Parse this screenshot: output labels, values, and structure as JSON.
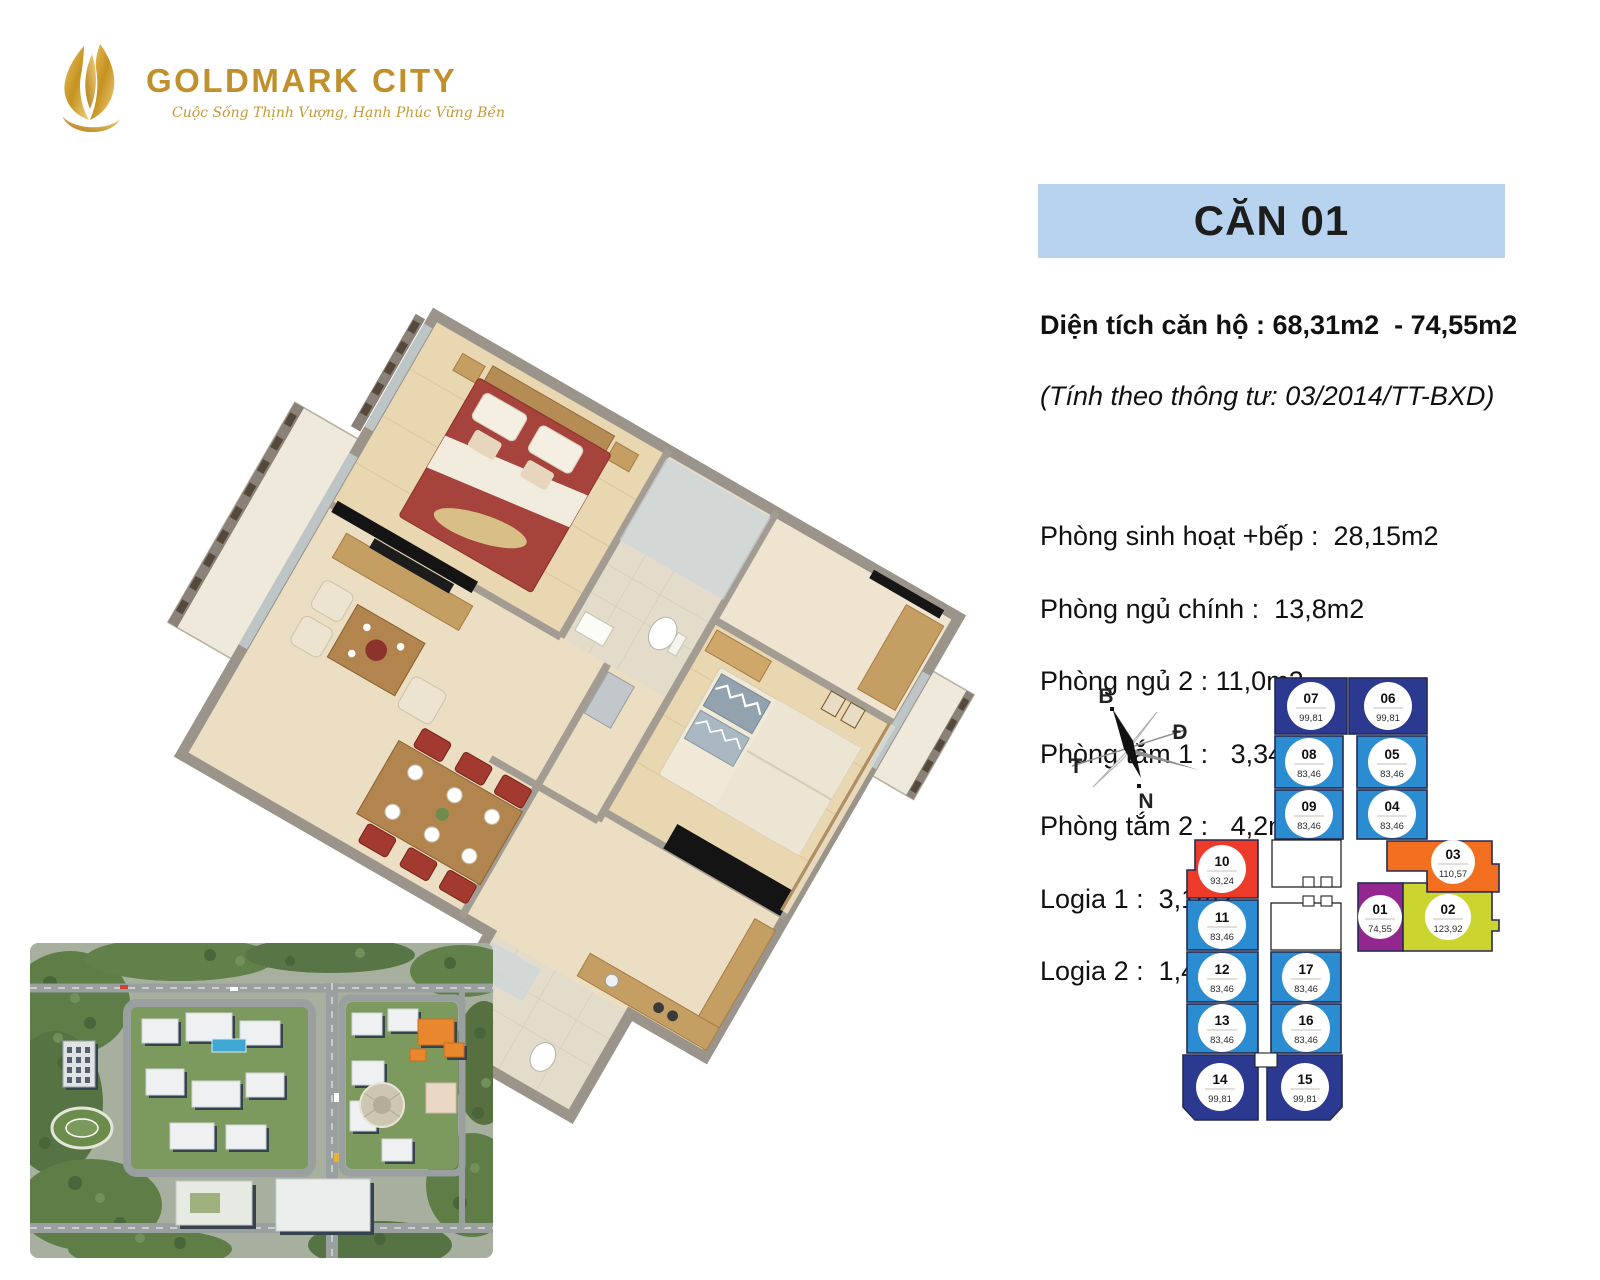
{
  "brand": {
    "name": "GOLDMARK CITY",
    "tagline": "Cuộc Sống Thịnh Vượng, Hạnh Phúc Vững Bền"
  },
  "unit_header": {
    "title": "CĂN 01"
  },
  "details": {
    "area_line": "Diện tích căn hộ : 68,31m2  - 74,55m2",
    "regulation_line": "(Tính theo thông tư: 03/2014/TT-BXD)",
    "rooms": [
      {
        "text": "Phòng sinh hoạt +bếp :  28,15m2"
      },
      {
        "text": "Phòng ngủ chính :  13,8m2"
      },
      {
        "text": "Phòng ngủ 2 : 11,0m2"
      },
      {
        "text": "Phòng tắm 1 :   3,34m2"
      },
      {
        "text": "Phòng tắm 2 :   4,2m2"
      },
      {
        "text": "Logia 1 :  3,1m2"
      },
      {
        "text": "Logia 2 :  1,44m2"
      }
    ]
  },
  "compass": {
    "north_label": "B",
    "east_label": "Đ",
    "west_label": "T",
    "south_label": "N"
  },
  "floor_plate": {
    "highlighted_unit": "01",
    "units": [
      {
        "id": "07",
        "area": "99,81",
        "color": "navy"
      },
      {
        "id": "06",
        "area": "99,81",
        "color": "navy"
      },
      {
        "id": "08",
        "area": "83,46",
        "color": "blue"
      },
      {
        "id": "05",
        "area": "83,46",
        "color": "blue"
      },
      {
        "id": "09",
        "area": "83,46",
        "color": "blue"
      },
      {
        "id": "04",
        "area": "83,46",
        "color": "blue"
      },
      {
        "id": "10",
        "area": "93,24",
        "color": "red"
      },
      {
        "id": "03",
        "area": "110,57",
        "color": "orange"
      },
      {
        "id": "11",
        "area": "83,46",
        "color": "blue"
      },
      {
        "id": "01",
        "area": "74,55",
        "color": "purple"
      },
      {
        "id": "02",
        "area": "123,92",
        "color": "yellow"
      },
      {
        "id": "12",
        "area": "83,46",
        "color": "blue"
      },
      {
        "id": "17",
        "area": "83,46",
        "color": "blue"
      },
      {
        "id": "13",
        "area": "83,46",
        "color": "blue"
      },
      {
        "id": "16",
        "area": "83,46",
        "color": "blue"
      },
      {
        "id": "14",
        "area": "99,81",
        "color": "navy"
      },
      {
        "id": "15",
        "area": "99,81",
        "color": "navy"
      }
    ]
  },
  "colors": {
    "navy": "#2b3990",
    "blue": "#2b8cd2",
    "red": "#ee3a28",
    "orange": "#f26f1f",
    "purple": "#93278f",
    "yellow": "#ccd52f",
    "gold": "#c0902c",
    "header_bg": "#b7d3ef"
  }
}
